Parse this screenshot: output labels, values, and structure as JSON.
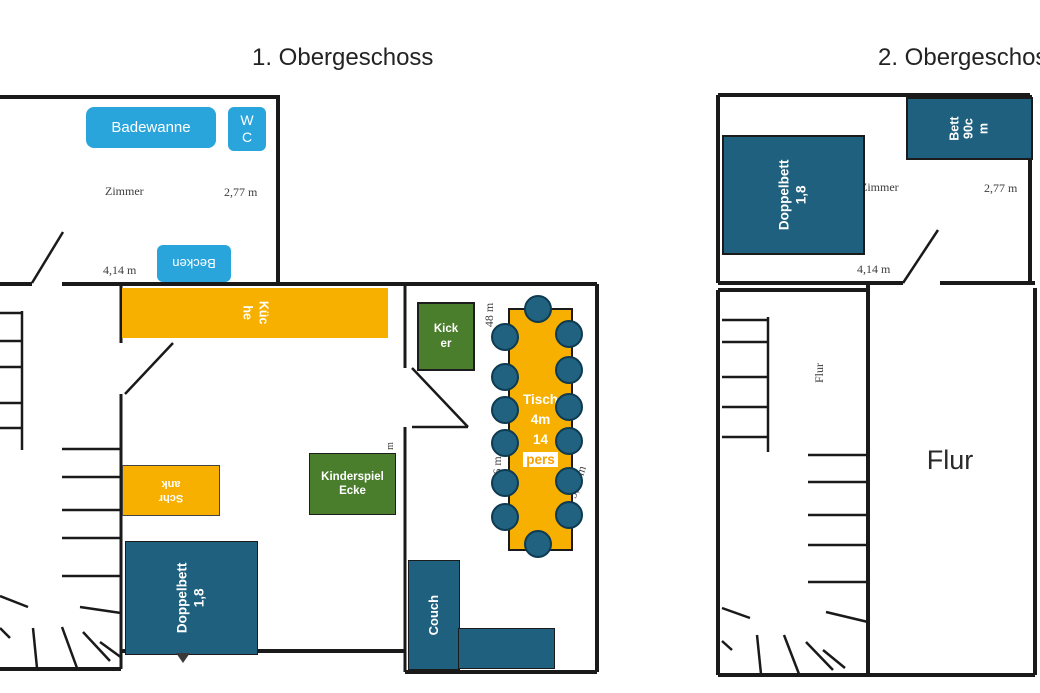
{
  "colors": {
    "chip_blue": "#2AA5DC",
    "furniture_blue": "#20607F",
    "orange": "#F8B000",
    "green": "#4A7E2D",
    "wall": "#1a1a1a",
    "dim_text": "#3d3d3d"
  },
  "floor1": {
    "title": "1. Obergeschoss",
    "bathroom": {
      "badewanne": "Badewanne",
      "wc_lines": [
        "W",
        "C"
      ],
      "becken": "Becken",
      "room_label": "Zimmer",
      "width_dim": "2,77 m",
      "length_dim": "4,14 m"
    },
    "living": {
      "kueche_lines": [
        "Küc",
        "he"
      ],
      "schrank_lines": [
        "Schr",
        "ank"
      ],
      "kinderspiel_lines": [
        "Kinderspiel",
        "Ecke"
      ],
      "doppelbett_lines": [
        "Doppelbett",
        "1,8"
      ],
      "wall_dim_m": "m"
    },
    "dining": {
      "kicker_lines": [
        "Kick",
        "er"
      ],
      "tisch_lines": [
        "Tisch",
        "4m",
        "14",
        "pers"
      ],
      "couch": "Couch",
      "dim_top": "48 m",
      "dim_left": "7,6 m",
      "dim_right": "5,93 m"
    }
  },
  "floor2": {
    "title": "2. Obergeschoss",
    "bedroom": {
      "doppelbett_lines": [
        "Doppelbett",
        "1,8"
      ],
      "bett_lines": [
        "Bett",
        "90c",
        "m"
      ],
      "room_label": "Zimmer",
      "width_dim": "2,77 m",
      "length_dim": "4,14 m"
    },
    "hall": {
      "flur_small": "Flur",
      "flur_large": "Flur"
    }
  }
}
